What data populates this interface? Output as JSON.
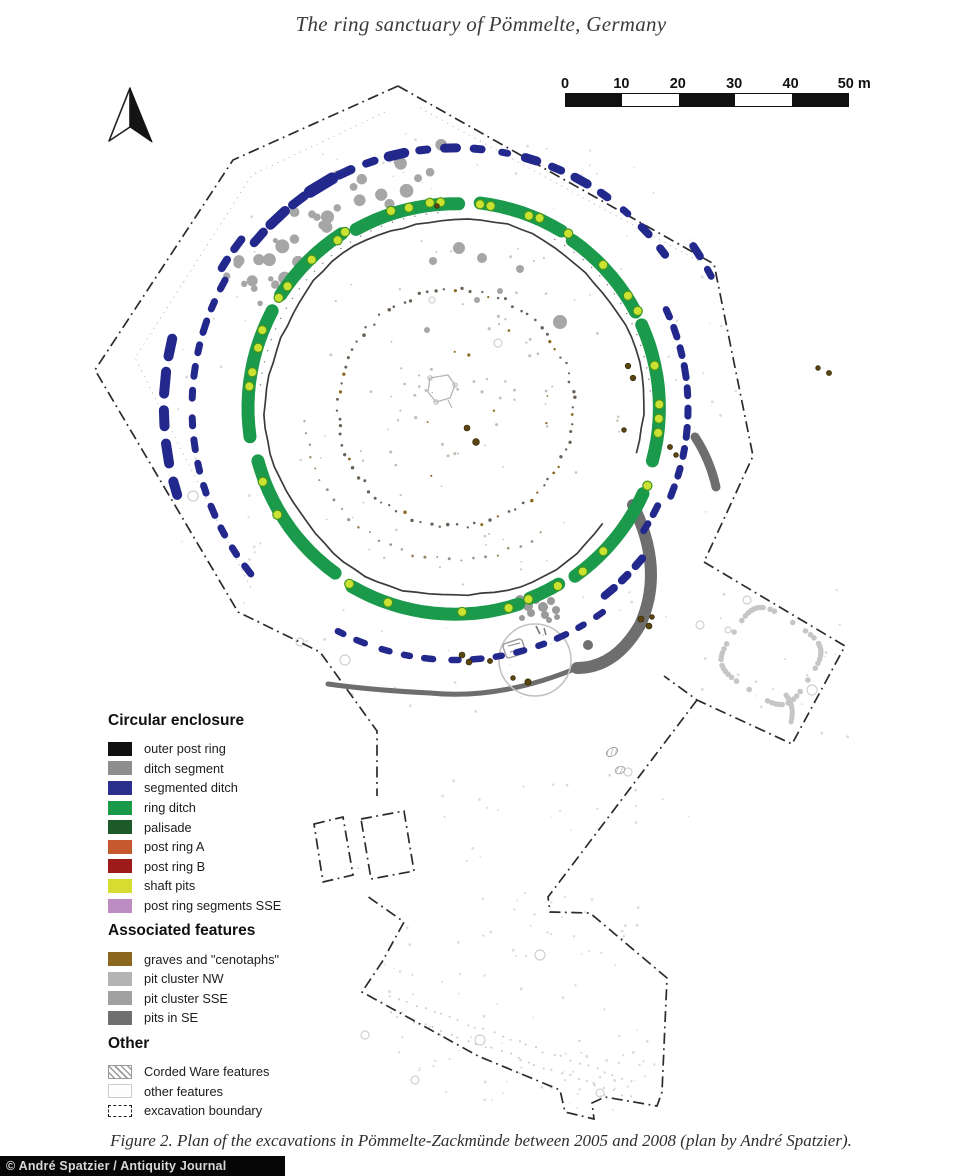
{
  "page": {
    "title": "The ring sanctuary of Pömmelte, Germany",
    "caption": "Figure 2.  Plan of the excavations in Pömmelte-Zackmünde between 2005 and 2008 (plan by André Spatzier).",
    "credit": "© André Spatzier / Antiquity Journal"
  },
  "scale_bar": {
    "tick_labels": [
      "0",
      "10",
      "20",
      "30",
      "40"
    ],
    "end_label": "50 m",
    "segment_colors": [
      "#111111",
      "#ffffff",
      "#111111",
      "#ffffff",
      "#111111"
    ]
  },
  "legend": {
    "sections": [
      {
        "title": "Circular enclosure",
        "items": [
          {
            "label": "outer post ring",
            "color": "#101010",
            "style": "solid"
          },
          {
            "label": "ditch segment",
            "color": "#8e8e8e",
            "style": "solid"
          },
          {
            "label": "segmented ditch",
            "color": "#2b2f8e",
            "style": "solid"
          },
          {
            "label": "ring ditch",
            "color": "#1b9a4b",
            "style": "solid"
          },
          {
            "label": "palisade",
            "color": "#1d5a2a",
            "style": "solid"
          },
          {
            "label": "post ring A",
            "color": "#c65a2e",
            "style": "solid"
          },
          {
            "label": "post ring B",
            "color": "#9e1b1b",
            "style": "solid"
          },
          {
            "label": "shaft pits",
            "color": "#d8dc30",
            "style": "solid"
          },
          {
            "label": "post ring segments SSE",
            "color": "#bd8cc3",
            "style": "solid"
          }
        ]
      },
      {
        "title": "Associated features",
        "items": [
          {
            "label": "graves and \"cenotaphs\"",
            "color": "#8a661e",
            "style": "solid"
          },
          {
            "label": "pit cluster NW",
            "color": "#b4b4b4",
            "style": "solid"
          },
          {
            "label": "pit cluster SSE",
            "color": "#a0a0a0",
            "style": "solid"
          },
          {
            "label": "pits in SE",
            "color": "#707070",
            "style": "solid"
          }
        ]
      },
      {
        "title": "Other",
        "items": [
          {
            "label": "Corded Ware features",
            "color": "#9a9a9a",
            "style": "hatched"
          },
          {
            "label": "other features",
            "color": "#fbfbfb",
            "style": "outline"
          },
          {
            "label": "excavation boundary",
            "color": "#222222",
            "style": "dashdot"
          }
        ]
      }
    ]
  },
  "map_colors": {
    "boundary": "#2b2b2b",
    "outer_post_ring": "#3b3b3b",
    "segmented_ditch": "#23288c",
    "ring_ditch": "#1b9a4b",
    "shaft_pit_fill": "#cbe232",
    "shaft_pit_stroke": "#43951f",
    "pit_cluster_nw": "#a6a6a6",
    "pit_cluster_sse": "#9a9a9a",
    "pits_in_se": "#6e6e6e",
    "graves": "#5a4410",
    "faint_feature": "#d2d2d2",
    "inner_dots": "#6b6156",
    "light_outline": "#c6c6c6"
  }
}
